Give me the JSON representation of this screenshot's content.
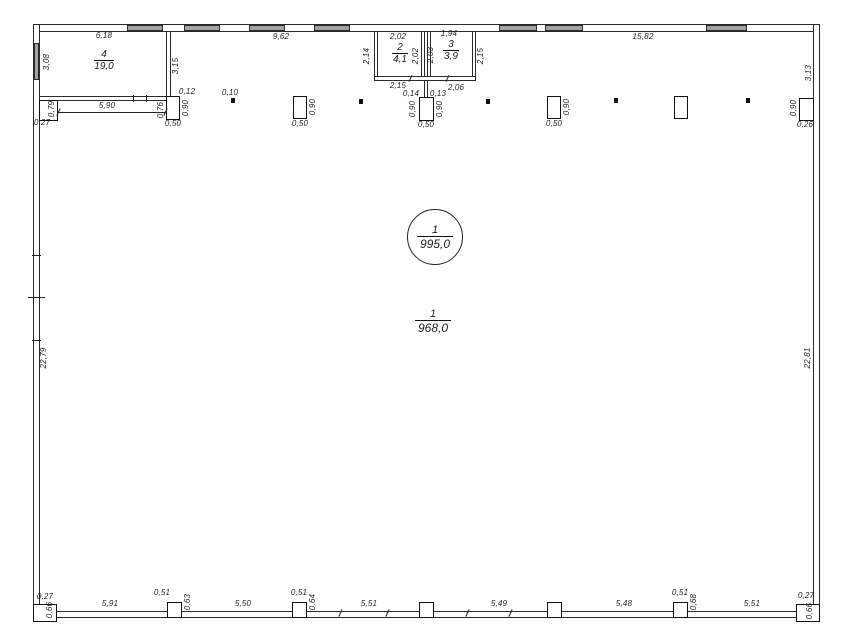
{
  "rooms": {
    "hall_circle": {
      "number": "1",
      "area": "995,0"
    },
    "hall": {
      "number": "1",
      "area": "968,0"
    },
    "room2": {
      "number": "2",
      "area": "4,1"
    },
    "room3": {
      "number": "3",
      "area": "3,9"
    },
    "room4": {
      "number": "4",
      "area": "19,0"
    }
  },
  "dims": {
    "top_room4": "6,18",
    "top_mid": "9,62",
    "top_right": "15,82",
    "left_window": "3,08",
    "left_wall": "22,79",
    "right_upper": "3,13",
    "right_wall": "22,81",
    "room4_right": "3,15",
    "room4_bottom": "5,90",
    "corner_col_w": "0,27",
    "corner_col_h": "0,79",
    "p2_left": "0,76",
    "p2_gap": "0,12",
    "p2_h": "0,90",
    "p2_w": "0,50",
    "dot1": "0,10",
    "p3_h": "0,90",
    "p3_w": "0,50",
    "room2_top": "2,02",
    "room2_left": "2,14",
    "room2_right": "2,02",
    "room2_bottom": "2,15",
    "room3_top": "1,94",
    "room3_left": "2,03",
    "room3_right": "2,15",
    "room3_bottom": "2,06",
    "stem_left": "0,14",
    "stem_right": "0,13",
    "p4_hl": "0,90",
    "p4_hr": "0,90",
    "p4_w": "0,50",
    "p5_h": "0,90",
    "p5_w": "0,50",
    "pr_h": "0,90",
    "pr_w": "0,26",
    "b_corner_l_w": "0,27",
    "b_corner_l_h": "0,66",
    "b_bay1": "5,91",
    "b_c2_w": "0,51",
    "b_c2_h": "0,63",
    "b_bay2": "5,50",
    "b_c3_w": "0,51",
    "b_c3_h": "0,64",
    "b_bay3": "5,51",
    "b_bay4": "5,49",
    "b_bay5": "5,48",
    "b_c6_w": "0,51",
    "b_c6_h": "0,68",
    "b_bay6": "5,51",
    "b_corner_r_w": "0,27",
    "b_corner_r_h": "0,66"
  }
}
